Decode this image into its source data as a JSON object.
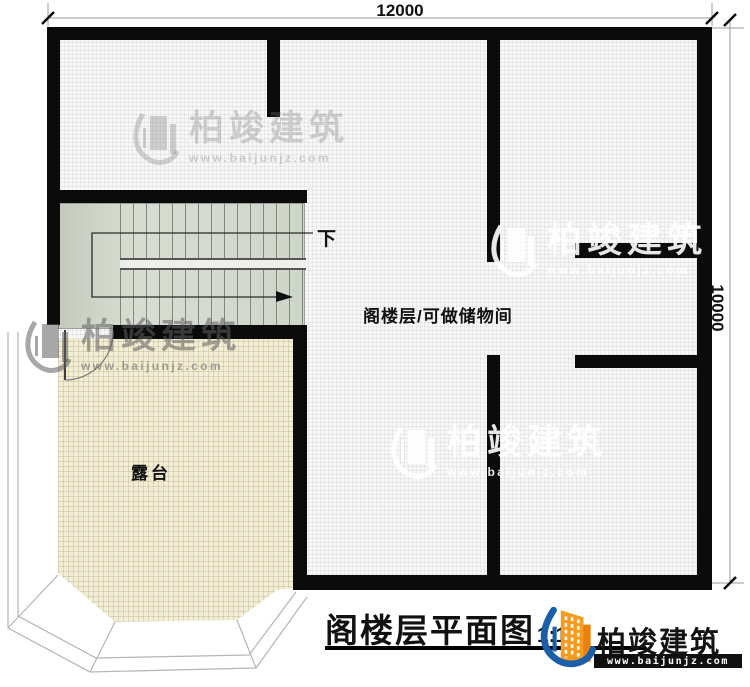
{
  "plan": {
    "dimension_top": "12000",
    "dimension_right": "10000",
    "label_stairs_down": "下",
    "label_attic_room": "阁楼层/可做储物间",
    "label_terrace": "露台"
  },
  "title": {
    "name": "阁楼层平面图",
    "scale": "1:100"
  },
  "branding": {
    "name": "柏竣建筑",
    "url": "www.baijunjz.com"
  },
  "watermark": {
    "name": "柏竣建筑",
    "url": "www.baijunjz.com"
  },
  "colors": {
    "wall": "#0b0b0b",
    "terrace_fill": "#f2edd6",
    "stairs_fill": "#ccd3c7",
    "brand_orange": "#f59b20",
    "brand_blue": "#1b5fa9"
  }
}
